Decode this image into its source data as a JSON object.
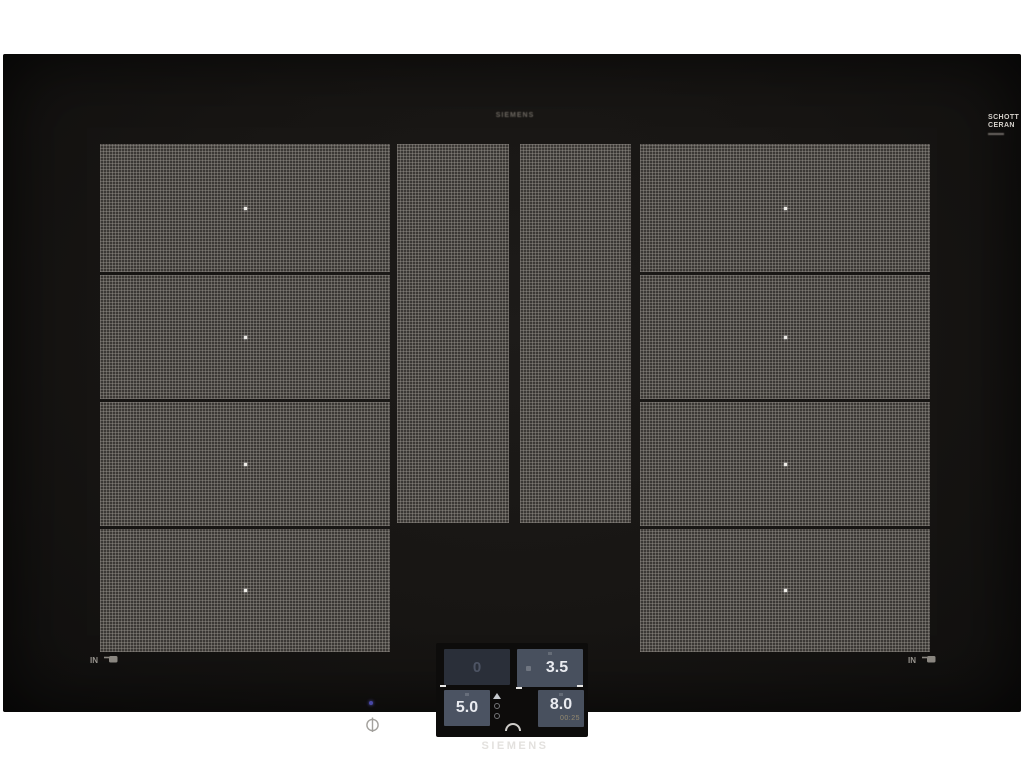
{
  "brand": {
    "model_print": "SIEMENS",
    "bottom_logo": "SIEMENS",
    "glass_line1": "SCHOTT",
    "glass_line2": "CERAN"
  },
  "markings": {
    "left_in_label": "IN",
    "right_in_label": "IN"
  },
  "panel": {
    "rear_left": {
      "value": "0"
    },
    "rear_right": {
      "value": "3.5"
    },
    "front_left": {
      "value": "5.0"
    },
    "front_right": {
      "value": "8.0",
      "timer": "00:25"
    }
  },
  "colors": {
    "glass_black": "#161413",
    "zone_texture_base": "#3b3835",
    "display_active": "#48505e",
    "display_dim": "#2a2f39",
    "value_text": "#e9ebf0",
    "timer_text": "#94896f",
    "led_blue": "#4848a6"
  }
}
